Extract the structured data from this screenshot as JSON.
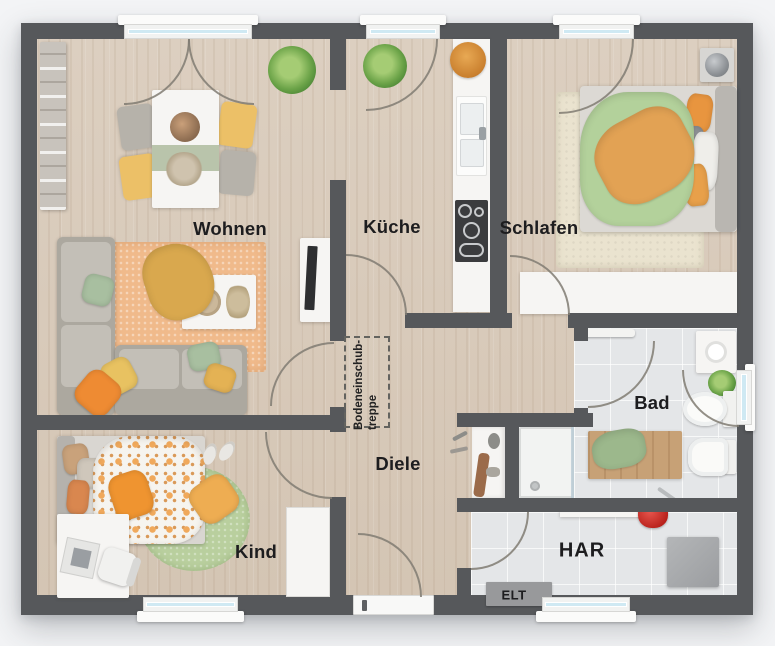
{
  "plan": {
    "type": "apartment-floor-plan",
    "rooms": [
      {
        "id": "wohnen",
        "label": "Wohnen"
      },
      {
        "id": "kueche",
        "label": "Küche"
      },
      {
        "id": "schlafen",
        "label": "Schlafen"
      },
      {
        "id": "bad",
        "label": "Bad"
      },
      {
        "id": "diele",
        "label": "Diele"
      },
      {
        "id": "kind",
        "label": "Kind"
      },
      {
        "id": "har",
        "label": "HAR"
      },
      {
        "id": "elt",
        "label": "ELT"
      }
    ],
    "annotations": {
      "attic_stairs_line1": "Bodeneinschub-",
      "attic_stairs_line2": "treppe"
    },
    "palette": {
      "wall": "#56585b",
      "wood_floor": "#d9ccbd",
      "tile_floor": "#e4e6e8",
      "window_glass": "#cfe9f3",
      "rug_peach": "#f0ba8b",
      "rug_green": "#b9cf9e",
      "rug_beige": "#eae3cf",
      "accent_orange": "#ef9430",
      "accent_yellow": "#ecc067",
      "accent_green": "#aecf9a",
      "accent_red": "#cc2b24",
      "label_color": "#1d1d1f"
    }
  }
}
